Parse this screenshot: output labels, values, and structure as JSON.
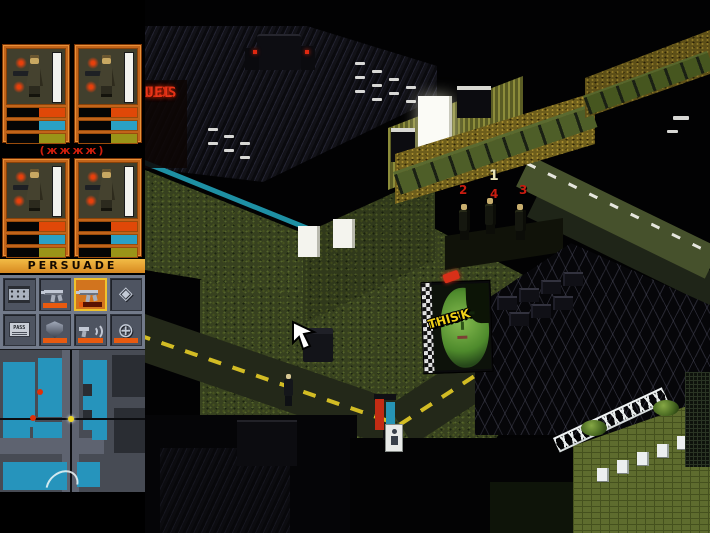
{
  "game": "Syndicate",
  "hud": {
    "persuade_label": "PERSUADE",
    "group_label": "(жжжж)",
    "agents": [
      {
        "id": 1,
        "health_pct": 100,
        "adrenaline_pct": 45,
        "perception_pct": 45,
        "intelligence_pct": 45
      },
      {
        "id": 2,
        "health_pct": 100,
        "adrenaline_pct": 45,
        "perception_pct": 45,
        "intelligence_pct": 45
      },
      {
        "id": 3,
        "health_pct": 100,
        "adrenaline_pct": 45,
        "perception_pct": 45,
        "intelligence_pct": 45
      },
      {
        "id": 4,
        "health_pct": 100,
        "adrenaline_pct": 45,
        "perception_pct": 45,
        "intelligence_pct": 45
      }
    ],
    "inventory": {
      "pass_card_label": "PASS",
      "gem_glyph": "◈",
      "scanner_glyph": "⊕",
      "slots": [
        {
          "name": "chip",
          "ammo": "none",
          "selected": false
        },
        {
          "name": "uzi",
          "ammo": "full",
          "selected": false
        },
        {
          "name": "uzi",
          "ammo": "low",
          "selected": true
        },
        {
          "name": "gem",
          "ammo": "none",
          "selected": false
        },
        {
          "name": "pass-card",
          "ammo": "none",
          "selected": false
        },
        {
          "name": "shield",
          "ammo": "full",
          "selected": false
        },
        {
          "name": "persuadertron",
          "ammo": "full",
          "selected": false
        },
        {
          "name": "scanner",
          "ammo": "full",
          "selected": false
        }
      ]
    },
    "minimap": {
      "enemy_dots": 2,
      "player_dots": 1,
      "enemy_color": "#e03008",
      "player_color": "#ecd424"
    }
  },
  "scene": {
    "neon_sign": {
      "line1": "ANT",
      "line2": "LDS",
      "line3": "UEL"
    },
    "billboard": {
      "line1": "DRINK",
      "line2": "THIS"
    },
    "squad_markers": {
      "n1": "1",
      "n2": "2",
      "n3": "3",
      "n4": "4"
    }
  },
  "colors": {
    "hud_frame": "#c2641a",
    "persuade_bar": "#e8a01c",
    "ipa_adrenaline": "#e04808",
    "ipa_perception": "#2aa0c4",
    "ipa_intelligence": "#9a9418",
    "health_bar": "#f2f2ee",
    "ammo_bar": "#e85a10",
    "minimap_cyan": "#2694bc"
  }
}
